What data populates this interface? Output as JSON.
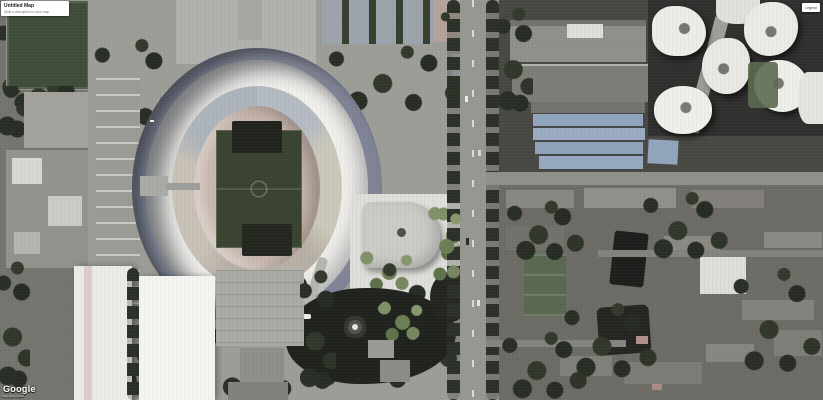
{
  "overlay": {
    "title_card": {
      "title": "Untitled Map",
      "subtitle": "Write a description for your map"
    },
    "legend_button": {
      "label": "Legend"
    },
    "watermark": {
      "logo": "Google",
      "attribution": "Map data ©2024"
    }
  },
  "scene": {
    "type": "satellite-imagery",
    "landmarks": [
      "oval-stadium",
      "training-pitch",
      "north-plaza",
      "tennis-courts",
      "modern-building-with-round-skylight",
      "park-lake-with-fountain",
      "blue-roof-warehouses",
      "white-tower-complex",
      "residential-blocks",
      "main-vertical-road",
      "exhibition-halls"
    ]
  },
  "colors": {
    "stadium_stands": "#ecebe7",
    "pitch_green": "#3b462f",
    "lake_water": "#232720",
    "blue_roof": "#8ca3bf",
    "road_asphalt": "#96968f"
  }
}
